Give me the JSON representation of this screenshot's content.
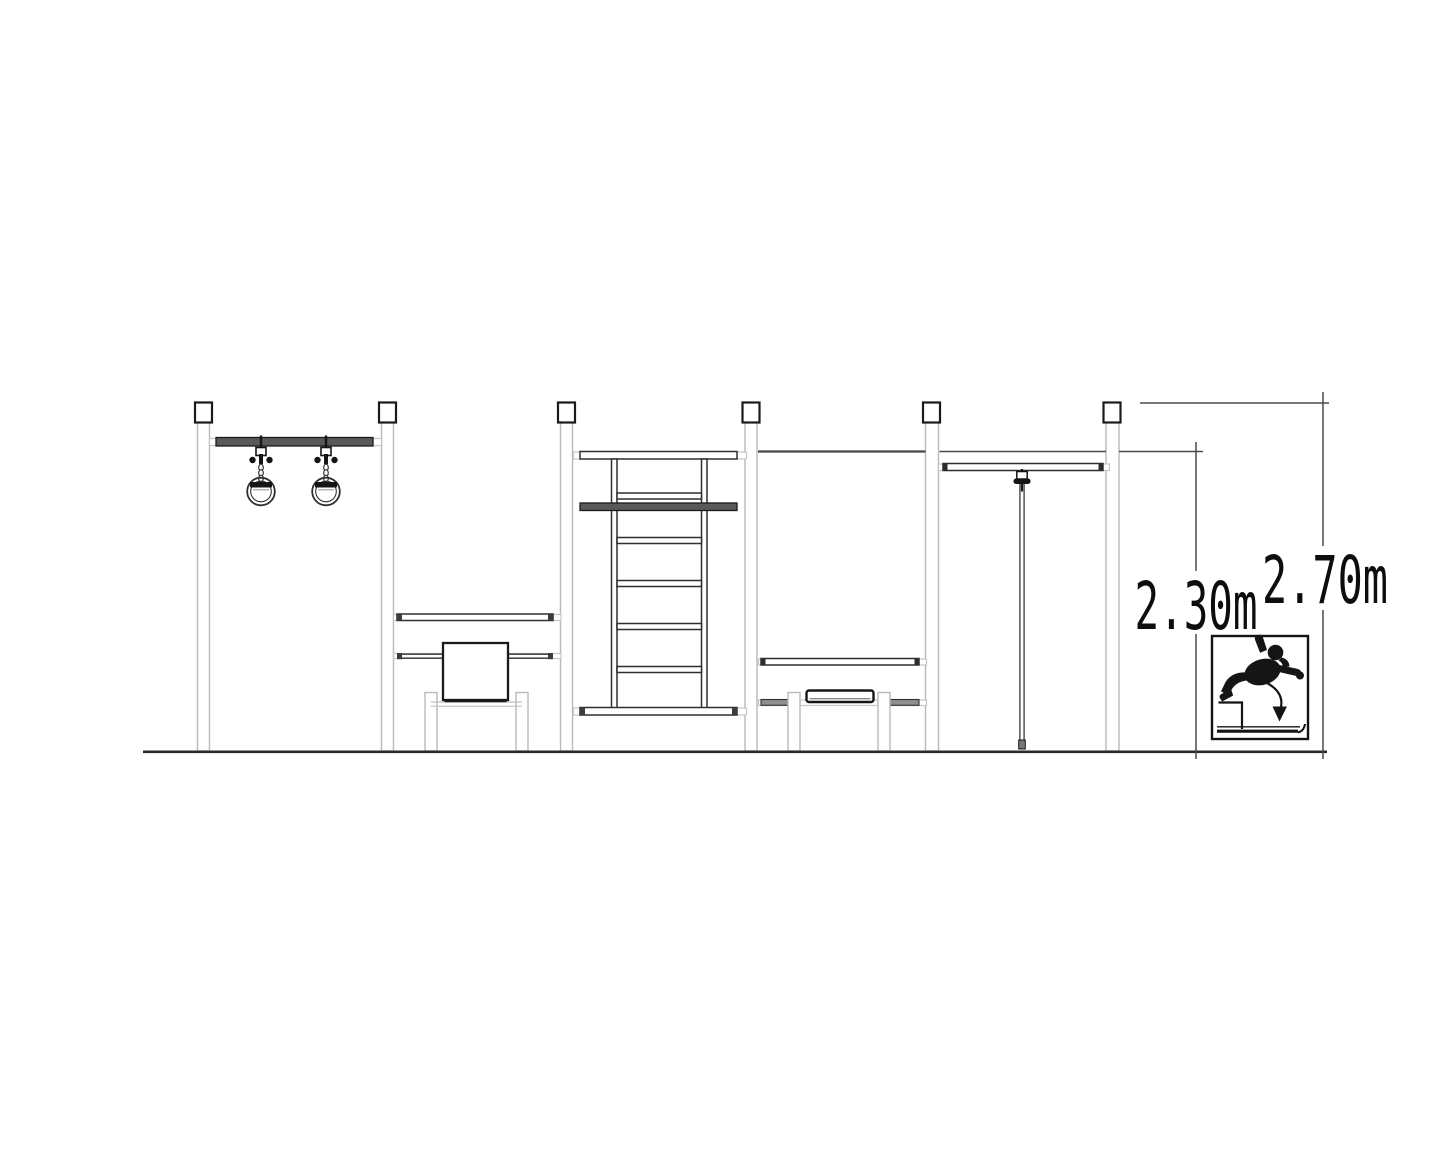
{
  "drawing": {
    "dimensions": [
      {
        "id": "bar-height",
        "label": "2.30m"
      },
      {
        "id": "post-height",
        "label": "2.70m"
      }
    ],
    "warning_icon": "fall-height-warning-icon",
    "colors": {
      "line": "#4a4a4a",
      "dark": "#1a1a1a",
      "beam_fill": "#595959",
      "post_outline": "#b9b9b9",
      "background": "#ffffff"
    }
  }
}
